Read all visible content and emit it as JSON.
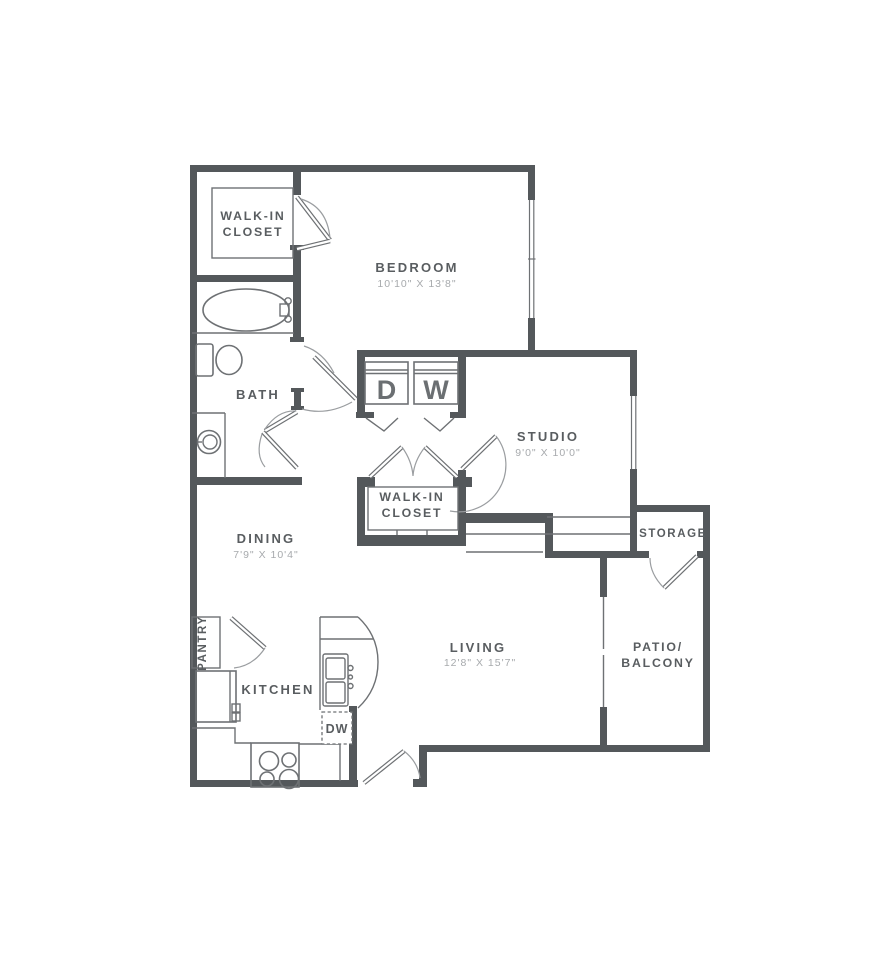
{
  "colors": {
    "background": "#ffffff",
    "wall": "#54585b",
    "fixture_line": "#6e7174",
    "label_text": "#595d60",
    "dims_text": "#a7aaad"
  },
  "rooms": {
    "walk_in_closet_1": {
      "line1": "WALK-IN",
      "line2": "CLOSET"
    },
    "bedroom": {
      "name": "BEDROOM",
      "dims": "10'10\" X 13'8\""
    },
    "bath": {
      "name": "BATH"
    },
    "dining": {
      "name": "DINING",
      "dims": "7'9\" X 10'4\""
    },
    "studio": {
      "name": "STUDIO",
      "dims": "9'0\" X 10'0\""
    },
    "walk_in_closet_2": {
      "line1": "WALK-IN",
      "line2": "CLOSET"
    },
    "storage": {
      "name": "STORAGE"
    },
    "living": {
      "name": "LIVING",
      "dims": "12'8\" X 15'7\""
    },
    "patio_balcony": {
      "line1": "PATIO/",
      "line2": "BALCONY"
    },
    "kitchen": {
      "name": "KITCHEN"
    },
    "pantry": {
      "name": "PANTRY"
    }
  },
  "appliances": {
    "dryer_label": "D",
    "washer_label": "W",
    "dishwasher_label": "DW"
  }
}
